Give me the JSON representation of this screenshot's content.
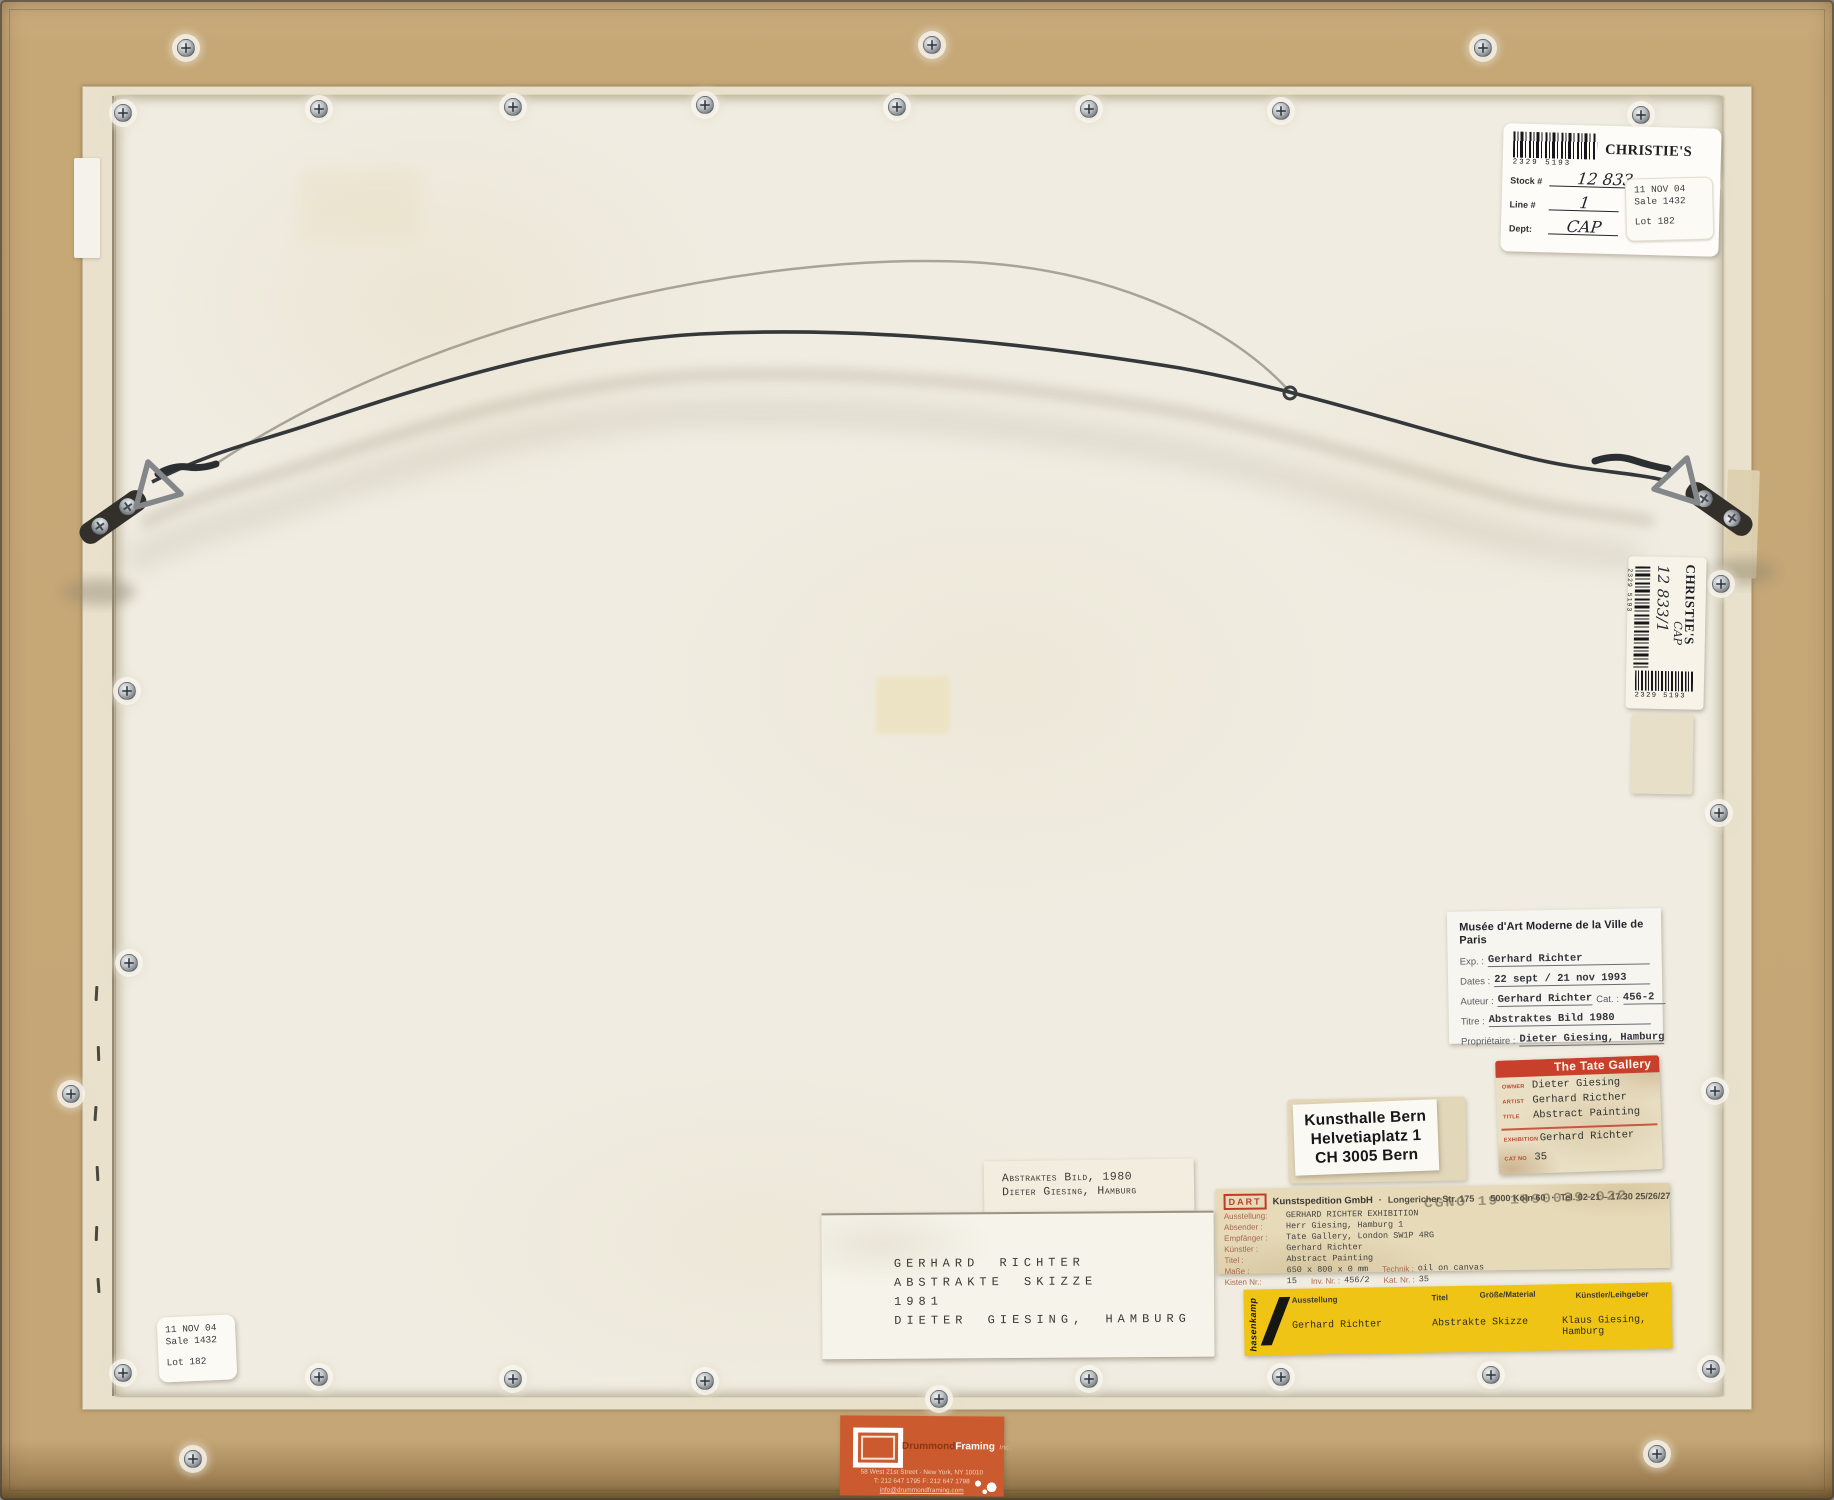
{
  "artwork_back": {
    "christies_label": {
      "brand": "CHRISTIE'S",
      "barcode": "2329 5193",
      "stock_label": "Stock #",
      "stock_value": "12 833",
      "line_label": "Line #",
      "line_value": "1",
      "dept_label": "Dept:",
      "dept_value": "CAP",
      "sale_sticker": {
        "date": "11 NOV 04",
        "sale": "Sale 1432",
        "lot": "Lot 182"
      }
    },
    "christies_side_label": {
      "brand": "CHRISTIE'S",
      "barcode": "2329 5193",
      "stock_value": "12 833/1",
      "dept_value": "CAP"
    },
    "musee_label": {
      "title": "Musée d'Art Moderne de la Ville de Paris",
      "exp_label": "Exp. :",
      "exp_value": "Gerhard Richter",
      "dates_label": "Dates :",
      "dates_value": "22 sept / 21 nov 1993",
      "auteur_label": "Auteur :",
      "auteur_value": "Gerhard Richter",
      "cat_label": "Cat. :",
      "cat_value": "456-2",
      "titre_label": "Titre :",
      "titre_value": "Abstraktes Bild 1980",
      "prop_label": "Propriétaire :",
      "prop_value": "Dieter Giesing, Hamburg"
    },
    "tate_label": {
      "header": "The Tate Gallery",
      "owner_label": "OWNER",
      "owner_value": "Dieter Giesing",
      "artist_label": "ARTIST",
      "artist_value": "Gerhard Ricther",
      "title_label": "TITLE",
      "title_value": "Abstract Painting",
      "exhibition_label": "EXHIBITION",
      "exhibition_value": "Gerhard Richter",
      "catno_label": "CAT NO",
      "catno_value": "35"
    },
    "kunsthalle_label": {
      "line1": "Kunsthalle Bern",
      "line2": "Helvetiaplatz 1",
      "line3": "CH 3005 Bern"
    },
    "dart_label": {
      "logo": "DART",
      "header_name": "Kunstspedition GmbH",
      "header_sep": "·",
      "header_street": "Longericher Str. 175",
      "header_city": "5000 Köln 60",
      "header_tel": "Tel. 02 21 – 17 30 25/26/27",
      "stamp": "CGNO 19 1090039-022",
      "ausstellung_l": "Ausstellung:",
      "ausstellung_v": "GERHARD RICHTER EXHIBITION",
      "absender_l": "Absender :",
      "absender_v": "Herr Giesing, Hamburg 1",
      "empfaenger_l": "Empfänger :",
      "empfaenger_v": "Tate Gallery, London SW1P 4RG",
      "kuenstler_l": "Künstler :",
      "kuenstler_v": "Gerhard Richter",
      "titel_l": "Titel :",
      "titel_v": "Abstract Painting",
      "masse_l": "Maße :",
      "masse_v": "650 x 800 x 0 mm",
      "technik_l": "Technik :",
      "technik_v": "oil on canvas",
      "kisten_l": "Kisten Nr.:",
      "kisten_v": "15",
      "inv_l": "Inv. Nr. :",
      "inv_v": "456/2",
      "kat_l": "Kat. Nr. :",
      "kat_v": "35"
    },
    "hasenkamp_label": {
      "logo": "hasenkamp",
      "col1_h": "Ausstellung",
      "col1_v": "Gerhard Richter",
      "col2_h": "Titel",
      "col2_v": "Abstrakte Skizze",
      "col3_h": "Größe/Material",
      "col4_h": "Künstler/Leihgeber",
      "col4_v": "Klaus Giesing,\nHamburg"
    },
    "title_small_label": {
      "line1": "Abstraktes Bild, 1980",
      "line2": "Dieter Giesing, Hamburg"
    },
    "title_large_label": {
      "line1": "GERHARD RICHTER",
      "line2": "ABSTRAKTE SKIZZE",
      "line3": "1981",
      "line4": "DIETER GIESING, HAMBURG"
    },
    "lot_sticker": {
      "date": "11 NOV 04",
      "sale": "Sale 1432",
      "lot": "Lot 182"
    },
    "framer_label": {
      "name1": "Drummond",
      "name2": "Framing",
      "name3": "Inc.",
      "address": "58 West 21st Street · New York, NY 10010",
      "phone": "T: 212 647 1795   F: 212 647 1798",
      "email": "info@drummondframing.com"
    }
  }
}
